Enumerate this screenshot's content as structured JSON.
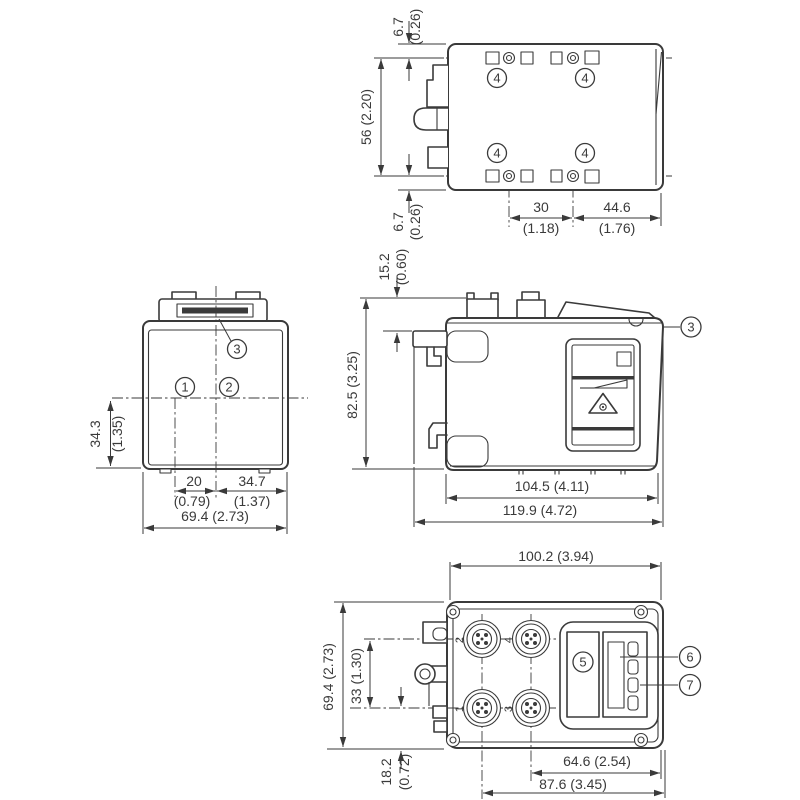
{
  "figure": {
    "type": "technical dimensional drawing, four orthographic views of an industrial sensor housing",
    "line_color": "#3a3a3a",
    "background": "#ffffff"
  },
  "views": {
    "top": {
      "dim_edge_to_hole_top": {
        "mm": "6.7",
        "inch": "(0.26)"
      },
      "dim_hole_rows": "56 (2.20)",
      "dim_edge_to_hole_bottom": {
        "mm": "6.7",
        "inch": "(0.26)"
      },
      "dim_hole_cols": {
        "mm": "30",
        "inch": "(1.18)"
      },
      "dim_hole_to_edge": {
        "mm": "44.6",
        "inch": "(1.76)"
      },
      "callout_mounting_hole": "4"
    },
    "front": {
      "dim_axis_height": {
        "mm": "34.3",
        "inch": "(1.35)"
      },
      "dim_axis_offset": {
        "mm": "20",
        "inch": "(0.79)"
      },
      "dim_axis_to_edge": {
        "mm": "34.7",
        "inch": "(1.37)"
      },
      "dim_width": "69.4 (2.73)",
      "callout_1": "1",
      "callout_2": "2",
      "callout_3": "3"
    },
    "side": {
      "dim_top_offset": {
        "mm": "15.2",
        "inch": "(0.60)"
      },
      "dim_height": "82.5 (3.25)",
      "dim_body_length": "104.5 (4.11)",
      "dim_total_length": "119.9 (4.72)",
      "callout_3": "3"
    },
    "bottom": {
      "dim_width": "100.2 (3.94)",
      "dim_height": "69.4 (2.73)",
      "dim_conn_rows": "33 (1.30)",
      "dim_conn_row_offset": {
        "mm": "18.2",
        "inch": "(0.72)"
      },
      "dim_col2_to_edge": "64.6 (2.54)",
      "dim_col1_to_edge": "87.6 (3.45)",
      "callout_5": "5",
      "callout_6": "6",
      "callout_7": "7",
      "port_labels": {
        "p1": "1",
        "p2": "2",
        "p3": "3",
        "p4": "4"
      }
    }
  }
}
